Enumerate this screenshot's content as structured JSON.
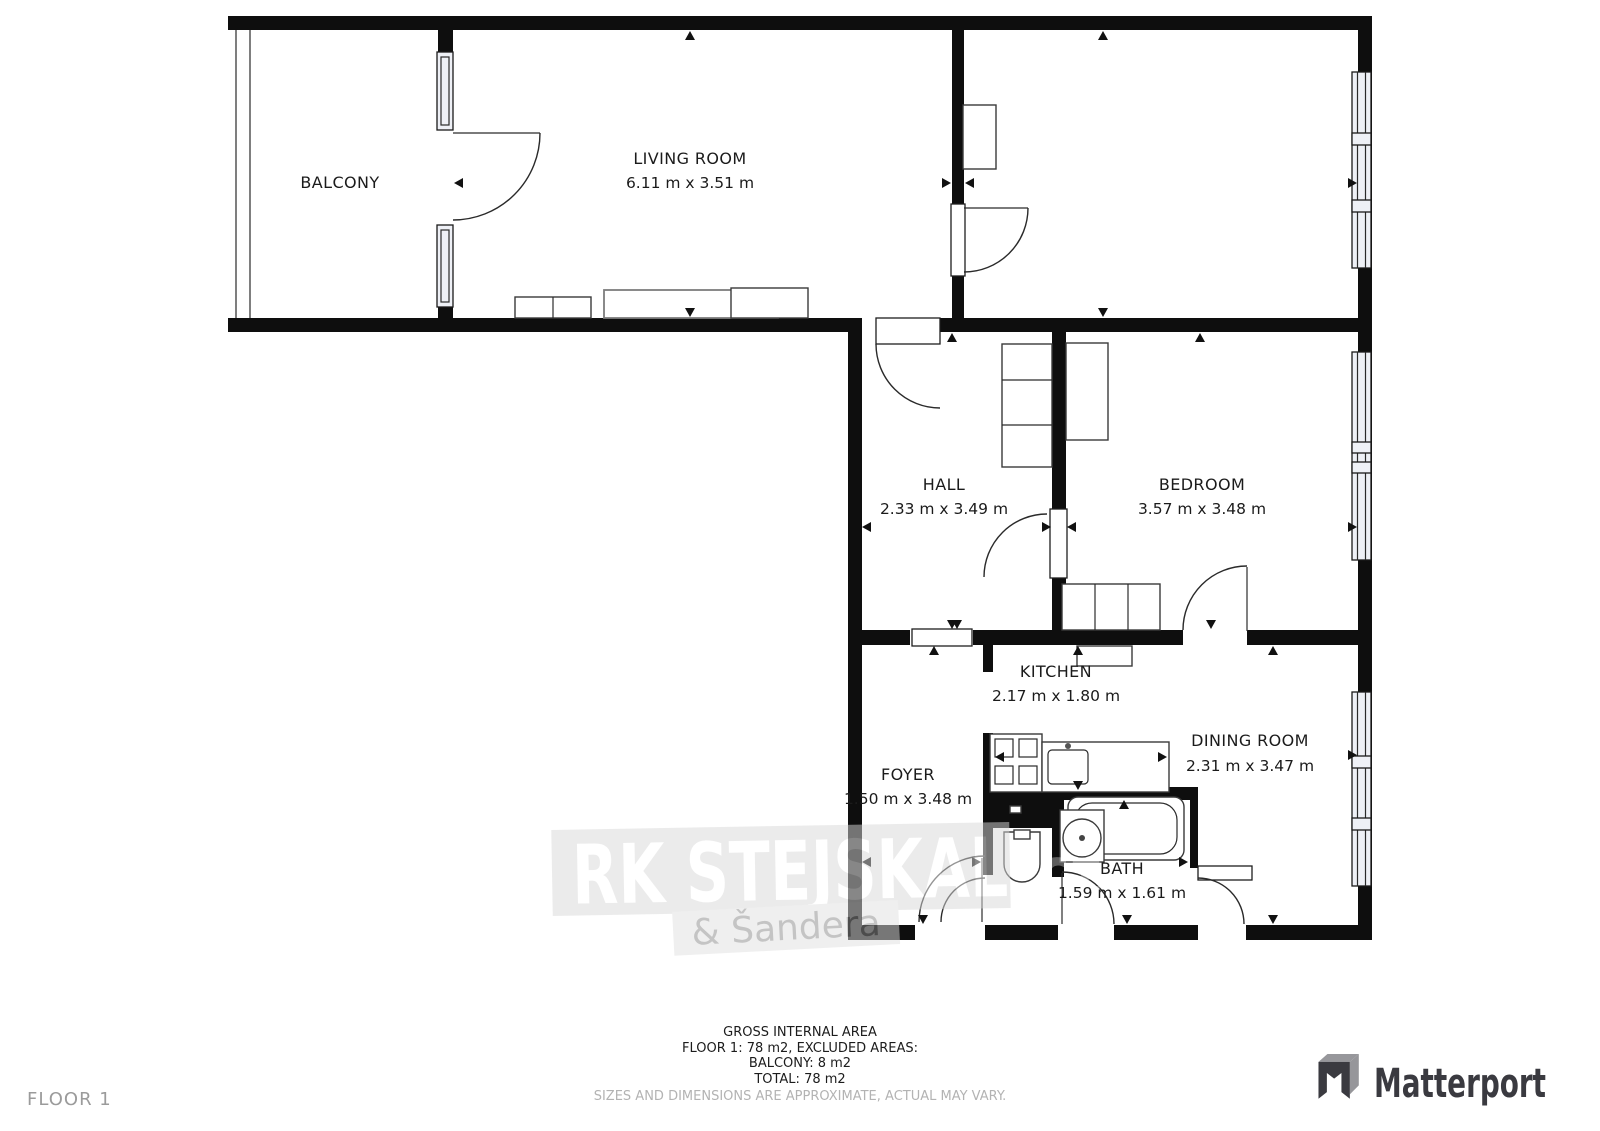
{
  "floor_plan": {
    "rooms": [
      {
        "id": "balcony",
        "name": "BALCONY",
        "dims": ""
      },
      {
        "id": "living-room",
        "name": "LIVING ROOM",
        "dims": "6.11 m x 3.51 m"
      },
      {
        "id": "hall",
        "name": "HALL",
        "dims": "2.33 m x 3.49 m"
      },
      {
        "id": "bedroom",
        "name": "BEDROOM",
        "dims": "3.57 m x 3.48 m"
      },
      {
        "id": "kitchen",
        "name": "KITCHEN",
        "dims": "2.17 m x 1.80 m"
      },
      {
        "id": "foyer",
        "name": "FOYER",
        "dims": "1.50 m x 3.48 m"
      },
      {
        "id": "bath",
        "name": "BATH",
        "dims": "1.59 m x 1.61 m"
      },
      {
        "id": "dining-room",
        "name": "DINING ROOM",
        "dims": "2.31 m x 3.47 m"
      }
    ]
  },
  "watermark": {
    "brand": "RK STEJSKAL",
    "suffix": ".cz",
    "subtitle": "& Šandera"
  },
  "footer": {
    "line1": "GROSS INTERNAL AREA",
    "line2": "FLOOR 1: 78 m2, EXCLUDED AREAS:",
    "line3": "BALCONY: 8 m2",
    "line4": "TOTAL: 78 m2",
    "disclaimer": "SIZES AND DIMENSIONS ARE APPROXIMATE, ACTUAL MAY VARY.",
    "floor_label": "FLOOR 1"
  },
  "brand": {
    "name": "Matterport"
  },
  "colors": {
    "wall": "#0e0e0e",
    "window_fill": "#eef0f6",
    "label": "#1b1b1b",
    "muted": "#b3b3b3",
    "logo": "#3a3a40"
  }
}
